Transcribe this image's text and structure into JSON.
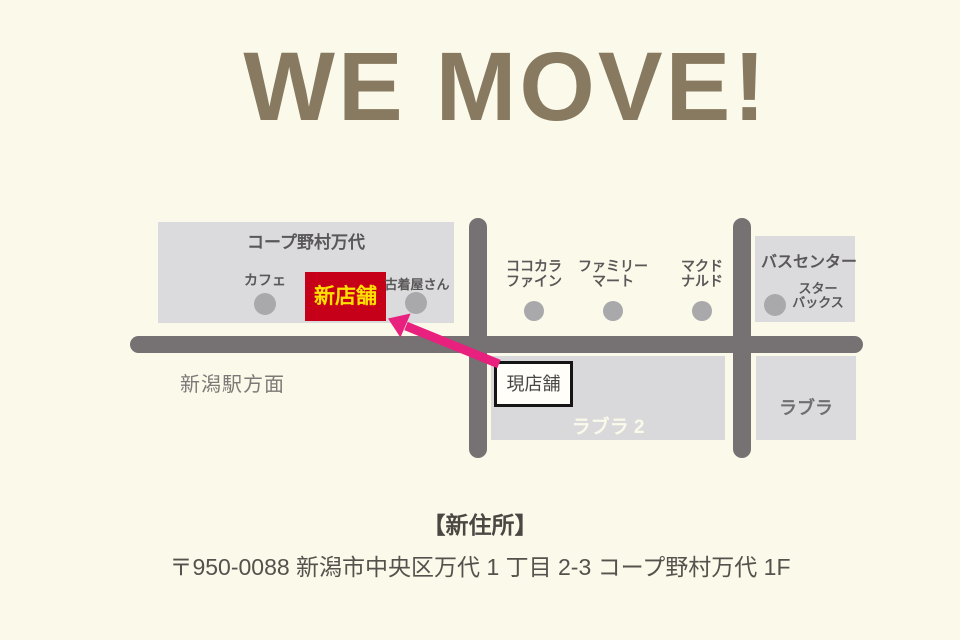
{
  "title": "WE MOVE!",
  "map": {
    "coop": {
      "name": "コープ野村万代",
      "cafe": "カフェ",
      "new_shop": "新店舗",
      "used_clothing": "古着屋さん"
    },
    "shops": [
      {
        "line1": "ココカラ",
        "line2": "ファイン"
      },
      {
        "line1": "ファミリー",
        "line2": "マート"
      },
      {
        "line1": "マクド",
        "line2": "ナルド"
      }
    ],
    "bus_center": {
      "name": "バスセンター",
      "tenant_line1": "スター",
      "tenant_line2": "バックス"
    },
    "current_shop": "現店舗",
    "labra2": "ラブラ 2",
    "labra": "ラブラ",
    "station_direction": "新潟駅方面"
  },
  "footer": {
    "heading": "【新住所】",
    "address": "〒950-0088 新潟市中央区万代 1 丁目 2-3 コープ野村万代 1F"
  },
  "colors": {
    "background": "#fbf9ea",
    "title_brown": "#877a61",
    "block_gray": "#dbdbdd",
    "road_gray": "#767172",
    "dot_gray": "#a9a8ab",
    "text_dark": "#595757",
    "new_shop_red": "#c70019",
    "new_shop_yellow": "#ffe100",
    "arrow_pink": "#e8217e"
  }
}
